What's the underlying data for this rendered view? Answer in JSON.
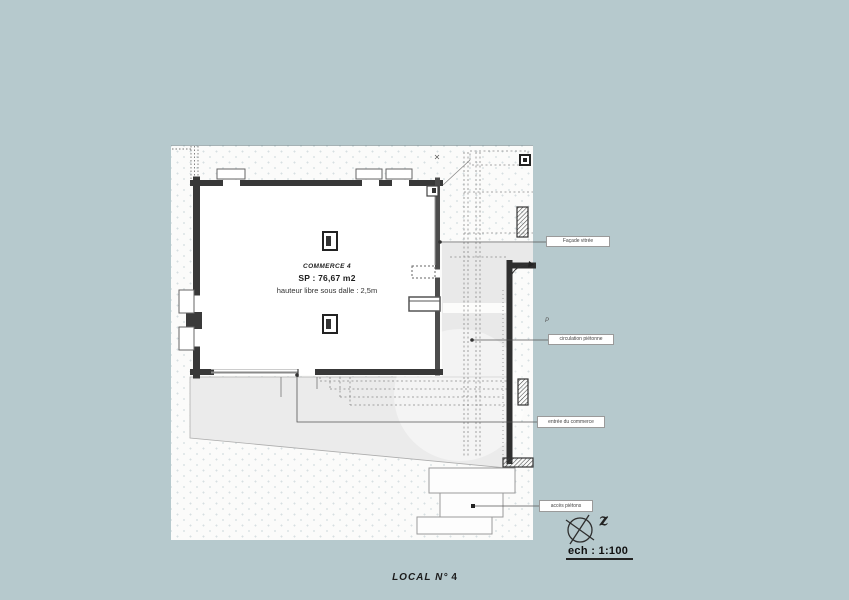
{
  "colors": {
    "background": "#b6c9cd",
    "paper": "#fbfbfa",
    "terrace_gray": "#e9e9e9",
    "wall": "#383838"
  },
  "room": {
    "name": "COMMERCE 4",
    "area": "SP : 76,67 m2",
    "height_note": "hauteur libre sous dalle : 2,5m"
  },
  "annotations": {
    "facade": "Façade vitrée",
    "circulation": "circulation piétonne",
    "entree": "entrée du commerce",
    "acces": "accès piétons"
  },
  "symbols": {
    "north_letter": "z",
    "parking_letter": "P"
  },
  "scale": {
    "label": "ech : 1:100"
  },
  "footer": {
    "label": "LOCAL N°",
    "number": "4"
  }
}
